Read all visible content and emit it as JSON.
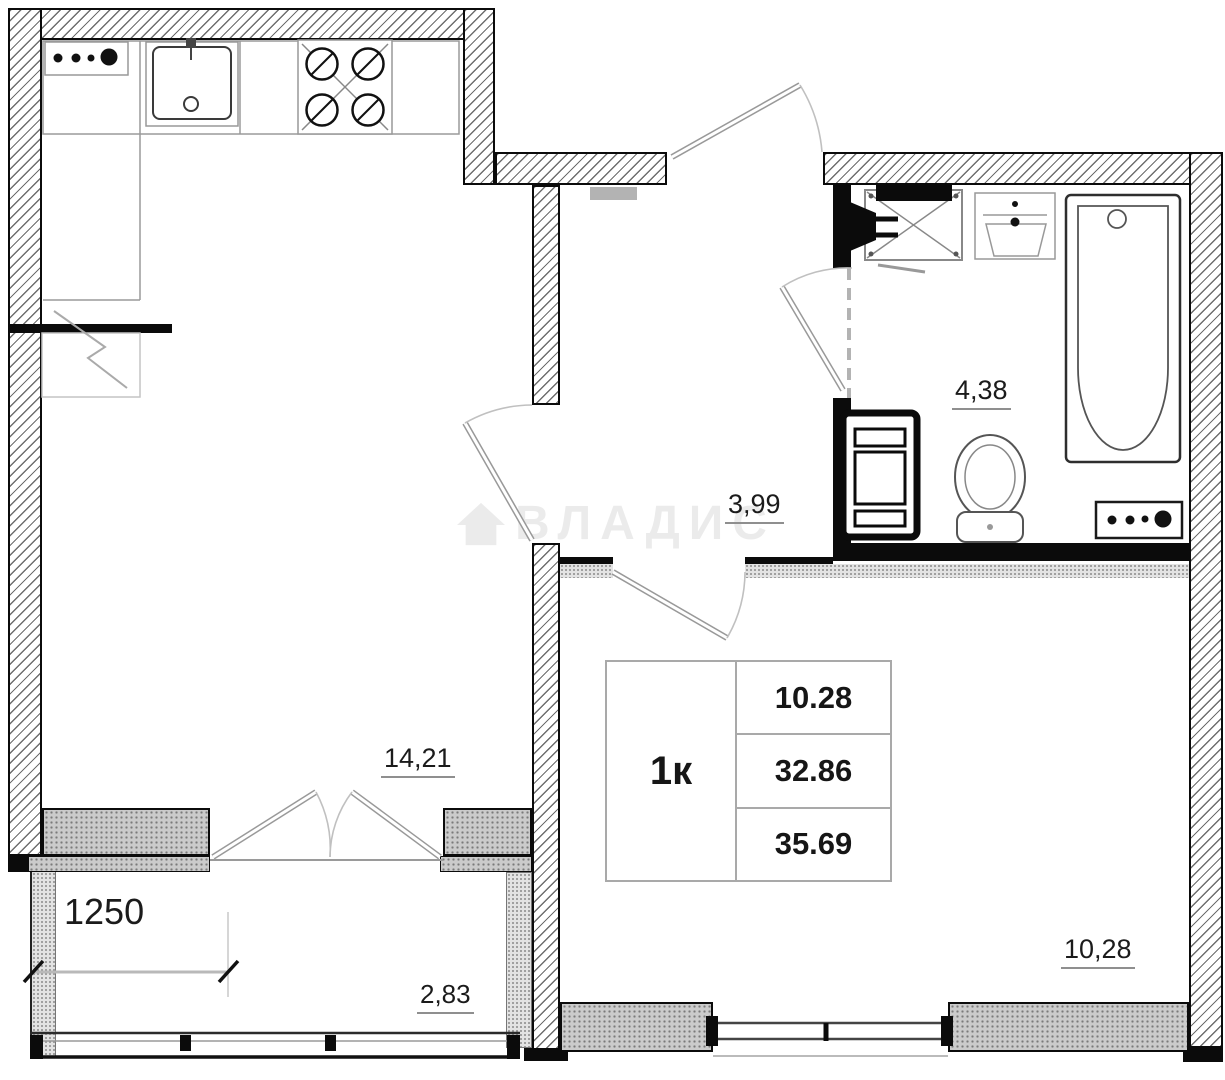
{
  "plan": {
    "watermark": {
      "text": "ВЛАДИС"
    },
    "info_table": {
      "type_label": "1к",
      "values": [
        "10.28",
        "32.86",
        "35.69"
      ]
    },
    "rooms": {
      "kitchen_living": {
        "area": "14,21"
      },
      "hallway": {
        "area": "3,99"
      },
      "bathroom": {
        "area": "4,38"
      },
      "bedroom": {
        "area": "10,28"
      },
      "balcony": {
        "area": "2,83"
      }
    },
    "dimensions": {
      "balcony_width": "1250"
    },
    "colors": {
      "wall": "#0b0b0b",
      "hatch_line": "#6e6e6e",
      "sill_fill": "#cbcbcb",
      "label_text": "#1b1b1b",
      "underline": "#8f8f8f",
      "watermark": "rgba(0,0,0,0.08)"
    }
  }
}
